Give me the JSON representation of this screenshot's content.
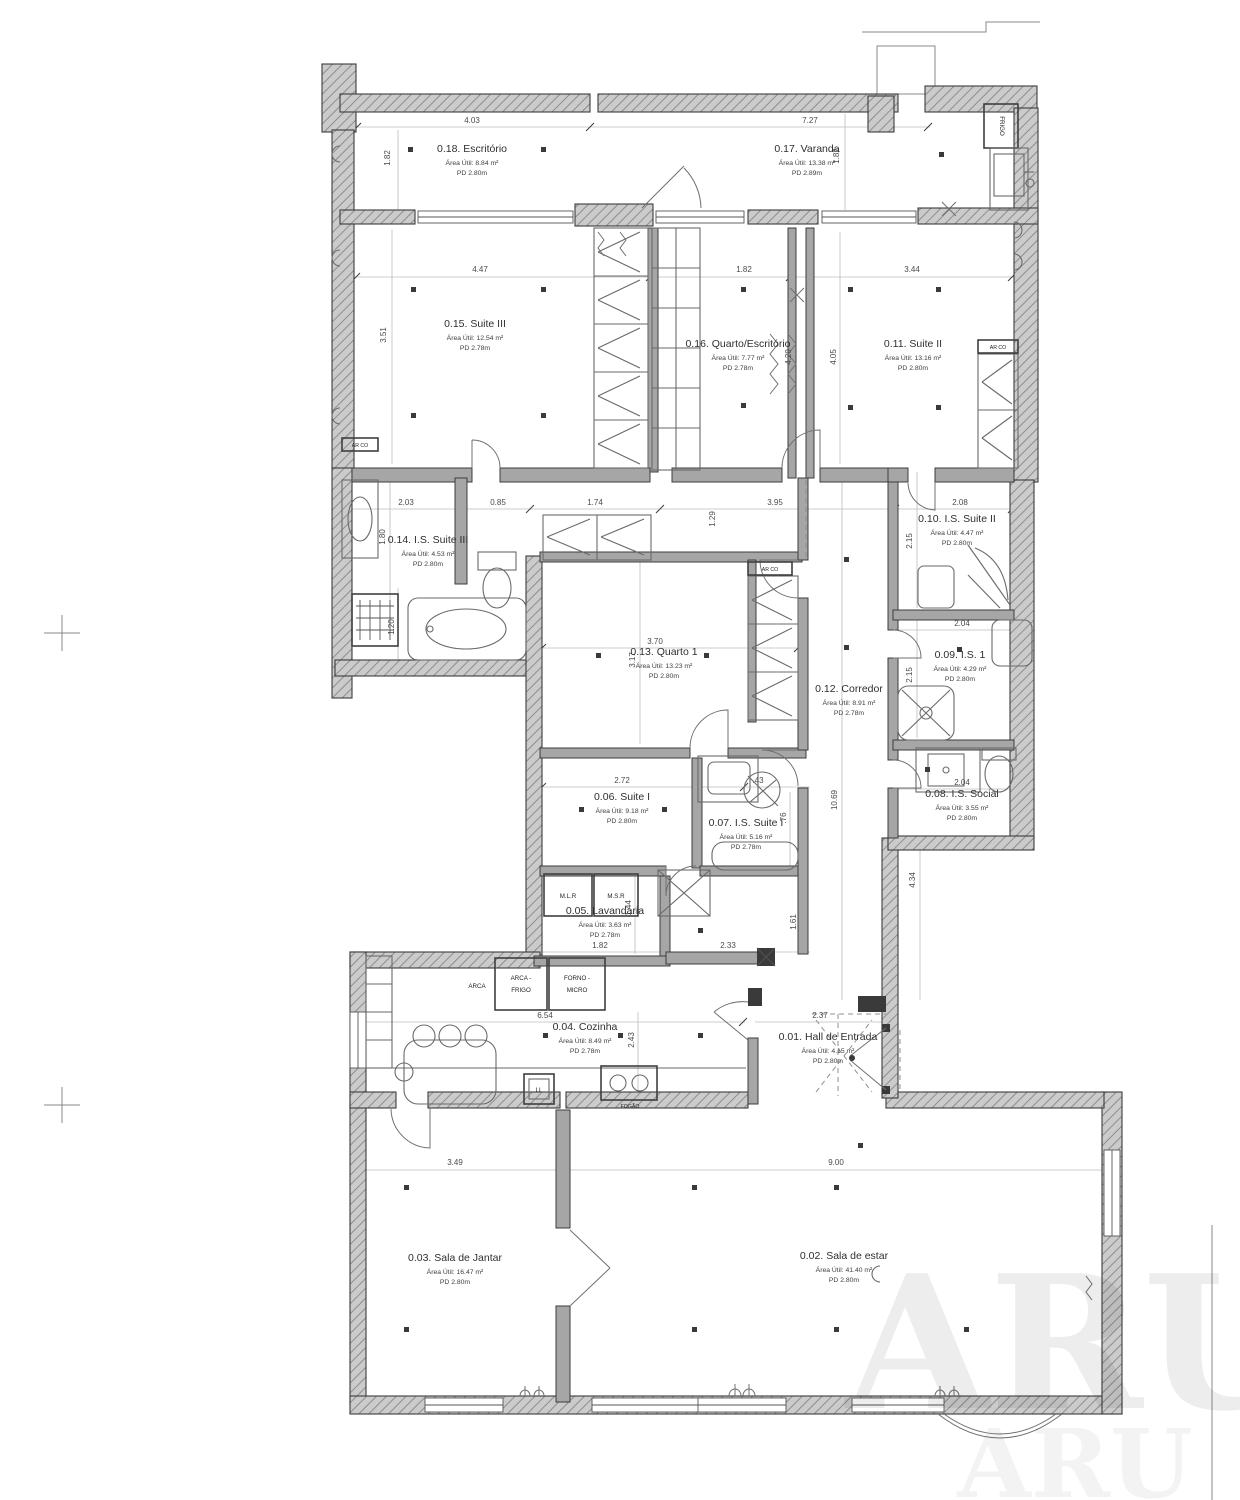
{
  "sheet": {
    "watermark": "ARU"
  },
  "rooms": {
    "r01": {
      "name": "0.01. Hall de Entrada",
      "area": "Área Útil: 4.15 m²",
      "pd": "PD 2.80m"
    },
    "r02": {
      "name": "0.02. Sala de estar",
      "area": "Área Útil: 41.40 m²",
      "pd": "PD 2.80m"
    },
    "r03": {
      "name": "0.03. Sala de Jantar",
      "area": "Área Útil: 16.47 m²",
      "pd": "PD 2.80m"
    },
    "r04": {
      "name": "0.04. Cozinha",
      "area": "Área Útil: 8.49 m²",
      "pd": "PD 2.78m"
    },
    "r05": {
      "name": "0.05. Lavandaria",
      "area": "Área Útil: 3.63 m²",
      "pd": "PD 2.78m"
    },
    "r06": {
      "name": "0.06. Suite I",
      "area": "Área Útil: 9.18 m²",
      "pd": "PD 2.80m"
    },
    "r07": {
      "name": "0.07. I.S. Suite I",
      "area": "Área Útil: 5.16 m²",
      "pd": "PD 2.78m"
    },
    "r08": {
      "name": "0.08. I.S. Social",
      "area": "Área Útil: 3.55 m²",
      "pd": "PD 2.80m"
    },
    "r09": {
      "name": "0.09. I.S. 1",
      "area": "Área Útil: 4.29 m²",
      "pd": "PD 2.80m"
    },
    "r10": {
      "name": "0.10. I.S. Suite II",
      "area": "Área Útil: 4.47 m²",
      "pd": "PD 2.80m"
    },
    "r11": {
      "name": "0.11. Suite II",
      "area": "Área Útil: 13.16 m²",
      "pd": "PD 2.80m"
    },
    "r12": {
      "name": "0.12. Corredor",
      "area": "Área Útil: 8.91 m²",
      "pd": "PD 2.78m"
    },
    "r13": {
      "name": "0.13. Quarto 1",
      "area": "Área Útil: 13.23 m²",
      "pd": "PD 2.80m"
    },
    "r14": {
      "name": "0.14. I.S. Suite III",
      "area": "Área Útil: 4.53 m²",
      "pd": "PD 2.80m"
    },
    "r15": {
      "name": "0.15. Suite III",
      "area": "Área Útil: 12.54 m²",
      "pd": "PD 2.78m"
    },
    "r16": {
      "name": "0.16. Quarto/Escritório",
      "area": "Área Útil: 7.77 m²",
      "pd": "PD 2.78m"
    },
    "r17": {
      "name": "0.17. Varanda",
      "area": "Área Útil: 13.38 m²",
      "pd": "PD 2.89m"
    },
    "r18": {
      "name": "0.18. Escritório",
      "area": "Área Útil: 8.84 m²",
      "pd": "PD 2.80m"
    }
  },
  "labels": {
    "frigo": "FRIGO",
    "arca": "ARCA",
    "arca_frigo_l1": "ARCA -",
    "arca_frigo_l2": "FRIGO",
    "forno_l1": "FORNO -",
    "forno_l2": "MICRO",
    "mlr": "M.L.R",
    "msr": "M.S.R",
    "ll": "LL",
    "fogao": "FOGÃO",
    "arco": "AR CO"
  },
  "dims": {
    "esc_w": "4.03",
    "esc_h": "1.82",
    "var_w": "7.27",
    "var_h": "1.82",
    "s3_w": "4.47",
    "s3_h": "3.51",
    "q16_w": "1.82",
    "q16_h1": "4.20",
    "q16_h2": "4.05",
    "s2_w": "3.44",
    "is3_w1": "2.03",
    "is3_w2": "0.85",
    "is3_h1": "1.80",
    "is3_h2": "1.20",
    "mid_w1": "1.74",
    "mid_h": "1.29",
    "mid_w2": "3.95",
    "is2_w": "2.08",
    "is2_h": "2.15",
    "q1_w": "3.70",
    "q1_h": "3.17",
    "is1_w": "2.04",
    "is1_h": "2.15",
    "s1_w": "2.72",
    "iss1_w": ".43",
    "iss1_h": ".76",
    "iso_w": "2.04",
    "cor_h": "10.69",
    "cor_h2": "4.34",
    "lav_w": "1.82",
    "lav_h": "1.44",
    "lav_w2": "2.33",
    "lav_h2": "1.61",
    "coz_w": "6.54",
    "coz_h": "2.43",
    "hall_w": "2.37",
    "jan_w": "3.49",
    "est_w": "9.00"
  }
}
